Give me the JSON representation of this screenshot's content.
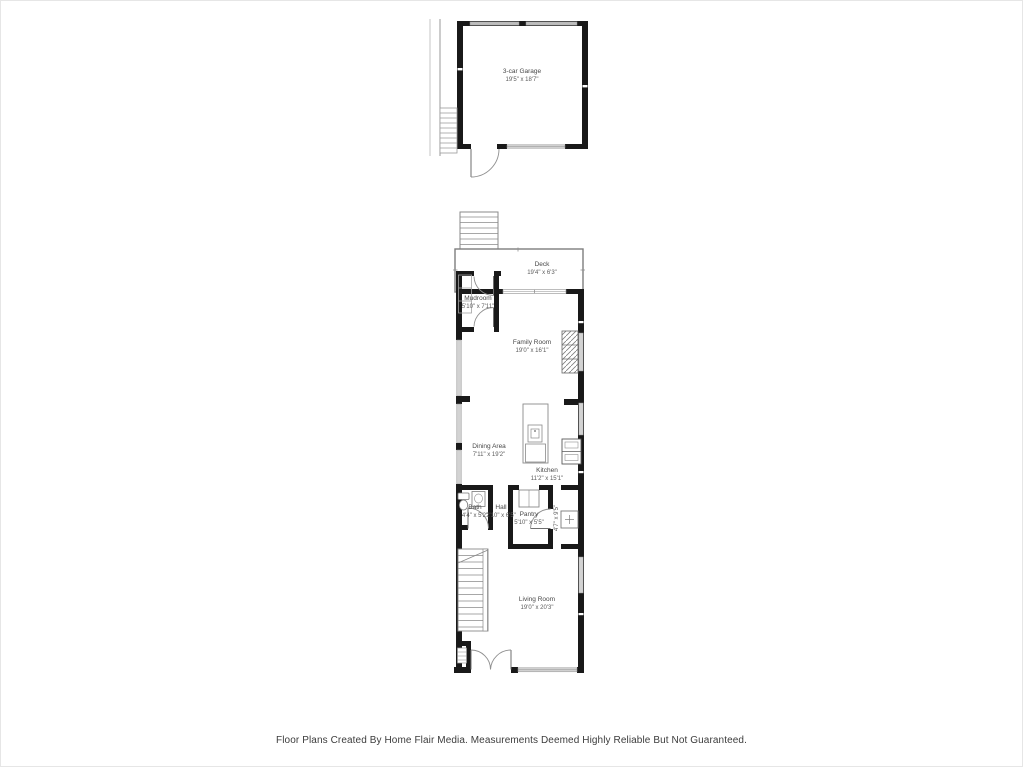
{
  "colors": {
    "wall": "#191919",
    "thin_line": "#8f8f8f",
    "window_fill": "#d3d3d3",
    "garage_door_fill": "#bdbdbd",
    "label_text": "#4d4d4d",
    "footer_text": "#3c3c3c",
    "background": "#ffffff"
  },
  "rooms": {
    "garage": {
      "name": "3-car Garage",
      "dims": "19'5\" x 18'7\""
    },
    "deck": {
      "name": "Deck",
      "dims": "19'4\" x 6'3\""
    },
    "mudroom": {
      "name": "Mudroom",
      "dims": "5'10\" x 7'11\""
    },
    "family_room": {
      "name": "Family Room",
      "dims": "19'0\" x 16'1\""
    },
    "dining_area": {
      "name": "Dining Area",
      "dims": "7'11\" x 19'2\""
    },
    "kitchen": {
      "name": "Kitchen",
      "dims": "11'2\" x 15'1\""
    },
    "bath": {
      "name": "Bath",
      "dims": "4'4\" x 5'2\""
    },
    "hall": {
      "name": "Hall",
      "dims": "2'10\" x 6'5\""
    },
    "pantry": {
      "name": "Pantry",
      "dims": "5'10\" x 5'5\""
    },
    "side_hall": {
      "dims": "4'7\" x 9'5\""
    },
    "living_room": {
      "name": "Living Room",
      "dims": "19'0\" x 20'3\""
    }
  },
  "footer": {
    "disclaimer": "Floor Plans Created By Home Flair Media. Measurements Deemed Highly Reliable But Not Guaranteed."
  }
}
